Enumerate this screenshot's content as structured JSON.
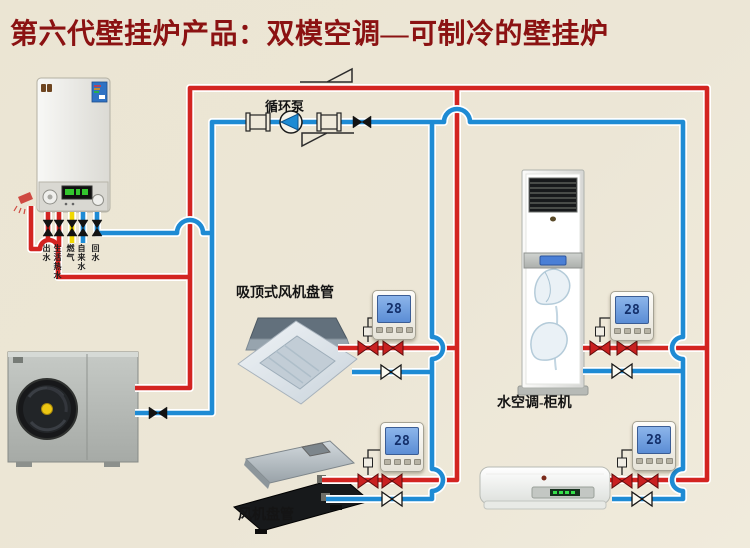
{
  "title": "第六代壁挂炉产品：双模空调—可制冷的壁挂炉",
  "pump": {
    "label": "循环泵"
  },
  "boiler": {
    "pipe_labels": [
      "出水",
      "生活热水",
      "燃气",
      "自来水",
      "回水"
    ]
  },
  "units": {
    "cassette_fan_coil": {
      "label": "吸顶式风机盘管"
    },
    "ducted_fan_coil": {
      "label": "风机盘管"
    },
    "floor_cabinet": {
      "label": "水空调-柜机"
    }
  },
  "thermostats": [
    {
      "value": "28"
    },
    {
      "value": "28"
    },
    {
      "value": "28"
    },
    {
      "value": "28"
    }
  ],
  "colors": {
    "background": "#ece6d5",
    "hot_water_pipe": "#d32421",
    "cold_water_pipe": "#1e8bd4",
    "gas_pipe": "#f0d800",
    "title_text": "#8b1212",
    "thermostat_screen": "#6f9fe0"
  }
}
